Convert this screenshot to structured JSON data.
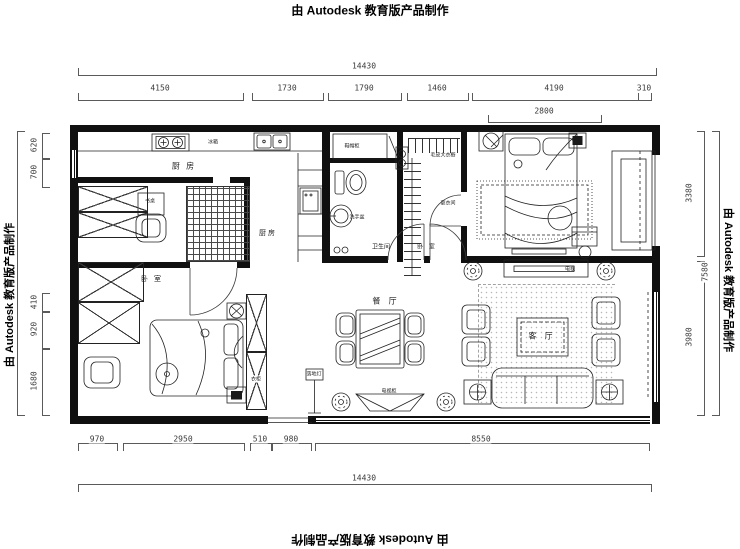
{
  "watermark": {
    "top": "由 Autodesk 教育版产品制作",
    "bottom": "由 Autodesk 教育版产品制作",
    "left": "由 Autodesk 教育版产品制作",
    "right": "由 Autodesk 教育版产品制作"
  },
  "dimensions": {
    "top_total": "14430",
    "top_segments": [
      "4150",
      "1730",
      "1790",
      "1460",
      "4190",
      "310"
    ],
    "bed_width": "2800",
    "left_segments": [
      "620",
      "700",
      "410",
      "920",
      "1680"
    ],
    "right_segments": [
      "3380",
      "3980"
    ],
    "right_total": "7580",
    "bottom_segments": [
      "970",
      "2950",
      "510",
      "980",
      "8550"
    ],
    "bottom_total": "14430"
  },
  "rooms": {
    "kitchen": "厨 房",
    "kitchen2": "厨 房",
    "bedroom_small": "卧 室",
    "bedroom_master": "卧 室",
    "bathroom": "卫生间",
    "dining": "餐 厅",
    "living": "客 厅",
    "closet_wardrobe": "毛皮大衣橱",
    "dressing": "更衣间",
    "shoe_cabinet": "鞋帽柜",
    "washbasin": "洗手盆"
  },
  "micro_labels": {
    "fridge": "冰箱",
    "desk": "书桌",
    "floor_lamp": "落地灯",
    "tv_stand": "电视柜",
    "tv": "电视",
    "wardrobe": "衣柜"
  }
}
